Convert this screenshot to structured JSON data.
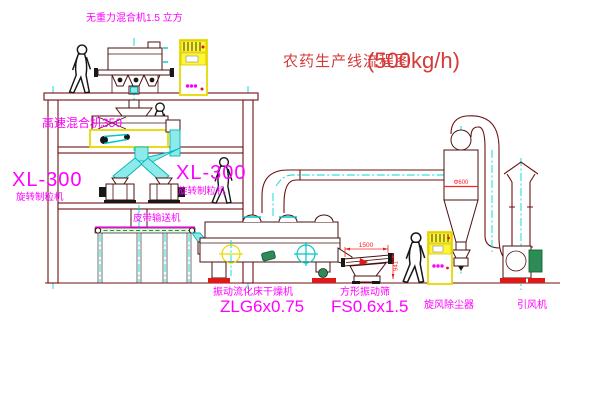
{
  "title": {
    "name": "农药生产线流程图",
    "capacity": "(500kg/h)"
  },
  "labels": {
    "gravity_mixer": "无重力混合机1.5 立方",
    "high_speed_mixer": "高速混合机350",
    "granulator_left_model": "XL-300",
    "granulator_left_name": "旋转制粒机",
    "granulator_right_model": "XL-300",
    "granulator_right_name": "旋转制粒机",
    "belt_conveyor": "皮带输送机",
    "dryer_name": "振动流化床干燥机",
    "dryer_model": "ZLG6x0.75",
    "sieve_name": "方形振动筛",
    "sieve_model": "FS0.6x1.5",
    "cyclone": "旋风除尘器",
    "fan": "引风机"
  },
  "dimensions": {
    "sieve_width": "1500",
    "sieve_side": "941",
    "cyclone_diameter": "Φ600"
  },
  "colors": {
    "structure_line": "#6e1111",
    "label_magenta": "#ff00ff",
    "title_red": "#d43c3c",
    "dimension_red": "#ff2020",
    "centerline_cyan": "#00d8d8",
    "cabinet_yellow": "#fff733",
    "conveyor_green": "#00aa00",
    "motor_green": "#2e8b57"
  }
}
